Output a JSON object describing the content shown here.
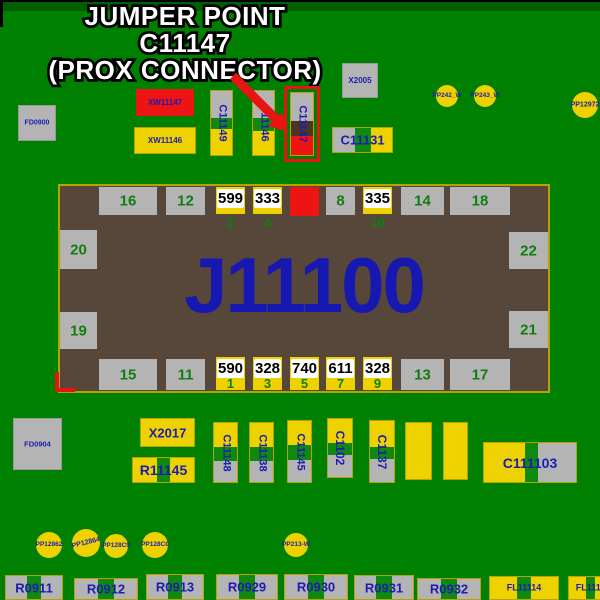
{
  "annotation": {
    "line1": "JUMPER POINT",
    "line2": "C11147",
    "line3": "(PROX CONNECTOR)"
  },
  "palette": {
    "board_green": "#008000",
    "pad_gray": "#b4b4b4",
    "pad_yellow": "#eed200",
    "pad_red": "#ee1414",
    "body_brown": "#57473a",
    "stripe_green": "#0f8a0f",
    "dark_brown": "#4b3626",
    "navy": "#1c1cb4",
    "pin_green": "#117d11",
    "highlight_red": "#e81414",
    "white": "#ffffff",
    "black": "#000000"
  },
  "main_component": {
    "refdes": "J11100",
    "x": 58,
    "y": 184,
    "w": 492,
    "h": 209,
    "top_pads": [
      {
        "label": "16",
        "kind": "gray",
        "x": 39,
        "w": 58
      },
      {
        "label": "12",
        "kind": "gray",
        "x": 106,
        "w": 39
      },
      {
        "label": "599",
        "pin": "2",
        "kind": "yellow",
        "x": 156,
        "w": 29
      },
      {
        "label": "333",
        "pin": "4",
        "kind": "yellow",
        "x": 193,
        "w": 29
      },
      {
        "label": "",
        "kind": "red",
        "x": 230,
        "w": 29
      },
      {
        "label": "8",
        "kind": "gray",
        "x": 266,
        "w": 29
      },
      {
        "label": "335",
        "pin": "10",
        "kind": "yellow",
        "x": 303,
        "w": 29
      },
      {
        "label": "14",
        "kind": "gray",
        "x": 341,
        "w": 43
      },
      {
        "label": "18",
        "kind": "gray",
        "x": 390,
        "w": 60
      }
    ],
    "bottom_pads": [
      {
        "label": "15",
        "kind": "gray",
        "x": 39,
        "w": 58
      },
      {
        "label": "11",
        "kind": "gray",
        "x": 106,
        "w": 39
      },
      {
        "label": "590",
        "pin": "1",
        "kind": "yellow",
        "x": 156,
        "w": 29
      },
      {
        "label": "328",
        "pin": "3",
        "kind": "yellow",
        "x": 193,
        "w": 29
      },
      {
        "label": "740",
        "pin": "5",
        "kind": "yellow",
        "x": 230,
        "w": 29
      },
      {
        "label": "611",
        "pin": "7",
        "kind": "yellow",
        "x": 266,
        "w": 29
      },
      {
        "label": "328",
        "pin": "9",
        "kind": "yellow",
        "x": 303,
        "w": 29
      },
      {
        "label": "13",
        "kind": "gray",
        "x": 341,
        "w": 43
      },
      {
        "label": "17",
        "kind": "gray",
        "x": 390,
        "w": 60
      }
    ],
    "left_pads": [
      {
        "label": "20",
        "y": 44,
        "h": 39
      },
      {
        "label": "19",
        "y": 126,
        "h": 37
      }
    ],
    "right_pads": [
      {
        "label": "22",
        "y": 46,
        "h": 37
      },
      {
        "label": "21",
        "y": 125,
        "h": 37
      }
    ]
  },
  "components": [
    {
      "name": "FD0900",
      "label": "FD0900",
      "shape": "rect",
      "fill": "pad_gray",
      "bd": "g",
      "x": 18,
      "y": 105,
      "w": 38,
      "h": 36,
      "fs": 7
    },
    {
      "name": "XW11147",
      "label": "XW11147",
      "shape": "rect",
      "fill": "pad_red",
      "x": 136,
      "y": 89,
      "w": 58,
      "h": 27,
      "fs": 8
    },
    {
      "name": "XW11146",
      "label": "XW11146",
      "shape": "rect",
      "fill": "pad_yellow",
      "bd": "y",
      "x": 134,
      "y": 127,
      "w": 62,
      "h": 27,
      "fs": 8
    },
    {
      "name": "C11149",
      "label": "C11149",
      "shape": "vseg",
      "bd": "y",
      "segs": [
        [
          "pad_gray",
          42
        ],
        [
          "stripe_green",
          18
        ],
        [
          "pad_yellow",
          40
        ]
      ],
      "x": 210,
      "y": 90,
      "w": 23,
      "h": 66,
      "fs": 11,
      "rot": true
    },
    {
      "name": "C11146",
      "label": "C11146",
      "shape": "vseg",
      "bd": "y",
      "segs": [
        [
          "pad_gray",
          42
        ],
        [
          "stripe_green",
          20
        ],
        [
          "pad_yellow",
          38
        ]
      ],
      "x": 252,
      "y": 90,
      "w": 23,
      "h": 66,
      "fs": 11,
      "rot": true
    },
    {
      "name": "C11147",
      "label": "C11147",
      "shape": "vseg",
      "bd": "y",
      "highlight": true,
      "segs": [
        [
          "pad_gray",
          45
        ],
        [
          "dark_brown",
          25
        ],
        [
          "pad_red",
          30
        ]
      ],
      "x": 290,
      "y": 92,
      "w": 24,
      "h": 64,
      "fs": 11,
      "rot": true
    },
    {
      "name": "X2005",
      "label": "X2005",
      "shape": "rect",
      "fill": "pad_gray",
      "bd": "g",
      "x": 342,
      "y": 63,
      "w": 36,
      "h": 35,
      "fs": 8
    },
    {
      "name": "C11131",
      "label": "C11131",
      "shape": "hseg",
      "bd": "y",
      "segs": [
        [
          "pad_gray",
          37
        ],
        [
          "stripe_green",
          27
        ],
        [
          "pad_yellow",
          36
        ]
      ],
      "x": 332,
      "y": 127,
      "w": 61,
      "h": 26,
      "fs": 13
    },
    {
      "name": "PP242_W",
      "label": "PP242_W",
      "shape": "circle",
      "x": 436,
      "y": 85,
      "w": 22,
      "h": 22,
      "fs": 6.5
    },
    {
      "name": "PP243_W",
      "label": "PP243_W",
      "shape": "circle",
      "x": 474,
      "y": 85,
      "w": 22,
      "h": 22,
      "fs": 6.5
    },
    {
      "name": "PP12972",
      "label": "PP12972",
      "shape": "circle",
      "x": 572,
      "y": 92,
      "w": 26,
      "h": 26,
      "fs": 7
    },
    {
      "name": "FD0904",
      "label": "FD0904",
      "shape": "rect",
      "fill": "pad_gray",
      "bd": "g",
      "x": 13,
      "y": 418,
      "w": 49,
      "h": 52,
      "fs": 7.5
    },
    {
      "name": "X2017",
      "label": "X2017",
      "shape": "rect",
      "fill": "pad_yellow",
      "bd": "y",
      "x": 140,
      "y": 418,
      "w": 55,
      "h": 29,
      "fs": 13
    },
    {
      "name": "R11145",
      "label": "R11145",
      "shape": "hseg",
      "bd": "y",
      "segs": [
        [
          "pad_yellow",
          40
        ],
        [
          "stripe_green",
          20
        ],
        [
          "pad_yellow",
          40
        ]
      ],
      "x": 132,
      "y": 457,
      "w": 63,
      "h": 26,
      "fs": 14
    },
    {
      "name": "C11148",
      "label": "C11148",
      "shape": "vseg",
      "bd": "y",
      "segs": [
        [
          "pad_yellow",
          40
        ],
        [
          "stripe_green",
          24
        ],
        [
          "pad_gray",
          36
        ]
      ],
      "x": 213,
      "y": 422,
      "w": 25,
      "h": 61,
      "fs": 11,
      "rot": true
    },
    {
      "name": "C11138",
      "label": "C11138",
      "shape": "vseg",
      "bd": "y",
      "segs": [
        [
          "pad_yellow",
          40
        ],
        [
          "stripe_green",
          24
        ],
        [
          "pad_gray",
          36
        ]
      ],
      "x": 249,
      "y": 422,
      "w": 25,
      "h": 61,
      "fs": 11,
      "rot": true
    },
    {
      "name": "C11145",
      "label": "C11145",
      "shape": "vseg",
      "bd": "y",
      "segs": [
        [
          "pad_yellow",
          40
        ],
        [
          "stripe_green",
          24
        ],
        [
          "pad_gray",
          36
        ]
      ],
      "x": 287,
      "y": 420,
      "w": 25,
      "h": 63,
      "fs": 11,
      "rot": true
    },
    {
      "name": "C1102",
      "label": "C1102",
      "shape": "vseg",
      "bd": "y",
      "segs": [
        [
          "pad_yellow",
          42
        ],
        [
          "stripe_green",
          20
        ],
        [
          "pad_gray",
          38
        ]
      ],
      "x": 327,
      "y": 418,
      "w": 26,
      "h": 60,
      "fs": 12,
      "rot": true
    },
    {
      "name": "C1137",
      "label": "C1137",
      "shape": "vseg",
      "bd": "y",
      "segs": [
        [
          "pad_yellow",
          42
        ],
        [
          "stripe_green",
          20
        ],
        [
          "pad_gray",
          38
        ]
      ],
      "x": 369,
      "y": 420,
      "w": 26,
      "h": 63,
      "fs": 12,
      "rot": true
    },
    {
      "name": "pad-unlabeled-1",
      "label": "",
      "shape": "rect",
      "fill": "pad_yellow",
      "bd": "y",
      "x": 405,
      "y": 422,
      "w": 27,
      "h": 58
    },
    {
      "name": "pad-unlabeled-2",
      "label": "",
      "shape": "rect",
      "fill": "pad_yellow",
      "bd": "y",
      "x": 443,
      "y": 422,
      "w": 25,
      "h": 58
    },
    {
      "name": "C111103",
      "label": "C111103",
      "shape": "hseg",
      "bd": "y",
      "segs": [
        [
          "pad_yellow",
          45
        ],
        [
          "stripe_green",
          14
        ],
        [
          "pad_gray",
          41
        ]
      ],
      "x": 483,
      "y": 442,
      "w": 94,
      "h": 41,
      "fs": 14
    },
    {
      "name": "PP12862",
      "label": "PP12862",
      "shape": "circle",
      "x": 36,
      "y": 532,
      "w": 26,
      "h": 26,
      "fs": 6.5
    },
    {
      "name": "PP12864",
      "label": "PP12864",
      "shape": "circle",
      "tilt": -14,
      "x": 72,
      "y": 529,
      "w": 28,
      "h": 28,
      "fs": 7
    },
    {
      "name": "PP128C9",
      "label": "PP128C9",
      "shape": "circle",
      "x": 104,
      "y": 534,
      "w": 24,
      "h": 24,
      "fs": 6.5
    },
    {
      "name": "PP128C0",
      "label": "PP128C0",
      "shape": "circle",
      "x": 142,
      "y": 532,
      "w": 26,
      "h": 26,
      "fs": 6.5
    },
    {
      "name": "PP213-W",
      "label": "PP213-W",
      "shape": "circle",
      "x": 284,
      "y": 533,
      "w": 24,
      "h": 24,
      "fs": 6.5
    },
    {
      "name": "R0911",
      "label": "R0911",
      "shape": "hseg",
      "bd": "y",
      "segs": [
        [
          "pad_gray",
          37
        ],
        [
          "stripe_green",
          26
        ],
        [
          "pad_gray",
          37
        ]
      ],
      "x": 5,
      "y": 575,
      "w": 58,
      "h": 25,
      "fs": 13
    },
    {
      "name": "R0912",
      "label": "R0912",
      "shape": "hseg",
      "bd": "y",
      "segs": [
        [
          "pad_gray",
          37
        ],
        [
          "stripe_green",
          26
        ],
        [
          "pad_gray",
          37
        ]
      ],
      "x": 74,
      "y": 578,
      "w": 64,
      "h": 22,
      "fs": 13
    },
    {
      "name": "R0913",
      "label": "R0913",
      "shape": "hseg",
      "bd": "y",
      "segs": [
        [
          "pad_gray",
          37
        ],
        [
          "stripe_green",
          26
        ],
        [
          "pad_gray",
          37
        ]
      ],
      "x": 146,
      "y": 574,
      "w": 58,
      "h": 26,
      "fs": 13
    },
    {
      "name": "R0929",
      "label": "R0929",
      "shape": "hseg",
      "bd": "y",
      "segs": [
        [
          "pad_gray",
          37
        ],
        [
          "stripe_green",
          26
        ],
        [
          "pad_gray",
          37
        ]
      ],
      "x": 216,
      "y": 574,
      "w": 62,
      "h": 26,
      "fs": 13
    },
    {
      "name": "R0930",
      "label": "R0930",
      "shape": "hseg",
      "bd": "y",
      "segs": [
        [
          "pad_gray",
          37
        ],
        [
          "stripe_green",
          26
        ],
        [
          "pad_gray",
          37
        ]
      ],
      "x": 284,
      "y": 574,
      "w": 64,
      "h": 26,
      "fs": 13
    },
    {
      "name": "R0931",
      "label": "R0931",
      "shape": "hseg",
      "bd": "y",
      "segs": [
        [
          "pad_gray",
          37
        ],
        [
          "stripe_green",
          26
        ],
        [
          "pad_gray",
          37
        ]
      ],
      "x": 354,
      "y": 575,
      "w": 60,
      "h": 25,
      "fs": 13
    },
    {
      "name": "R0932",
      "label": "R0932",
      "shape": "hseg",
      "bd": "y",
      "segs": [
        [
          "pad_gray",
          37
        ],
        [
          "stripe_green",
          26
        ],
        [
          "pad_gray",
          37
        ]
      ],
      "x": 417,
      "y": 578,
      "w": 64,
      "h": 22,
      "fs": 13
    },
    {
      "name": "FL11114",
      "label": "FL11114",
      "shape": "hseg",
      "bd": "y",
      "segs": [
        [
          "pad_yellow",
          40
        ],
        [
          "stripe_green",
          20
        ],
        [
          "pad_yellow",
          40
        ]
      ],
      "x": 489,
      "y": 576,
      "w": 70,
      "h": 24,
      "fs": 9
    },
    {
      "name": "FL1111",
      "label": "FL1111",
      "shape": "hseg",
      "bd": "y",
      "segs": [
        [
          "pad_yellow",
          40
        ],
        [
          "stripe_green",
          20
        ],
        [
          "pad_yellow",
          40
        ]
      ],
      "x": 568,
      "y": 576,
      "w": 45,
      "h": 24,
      "fs": 9
    }
  ]
}
